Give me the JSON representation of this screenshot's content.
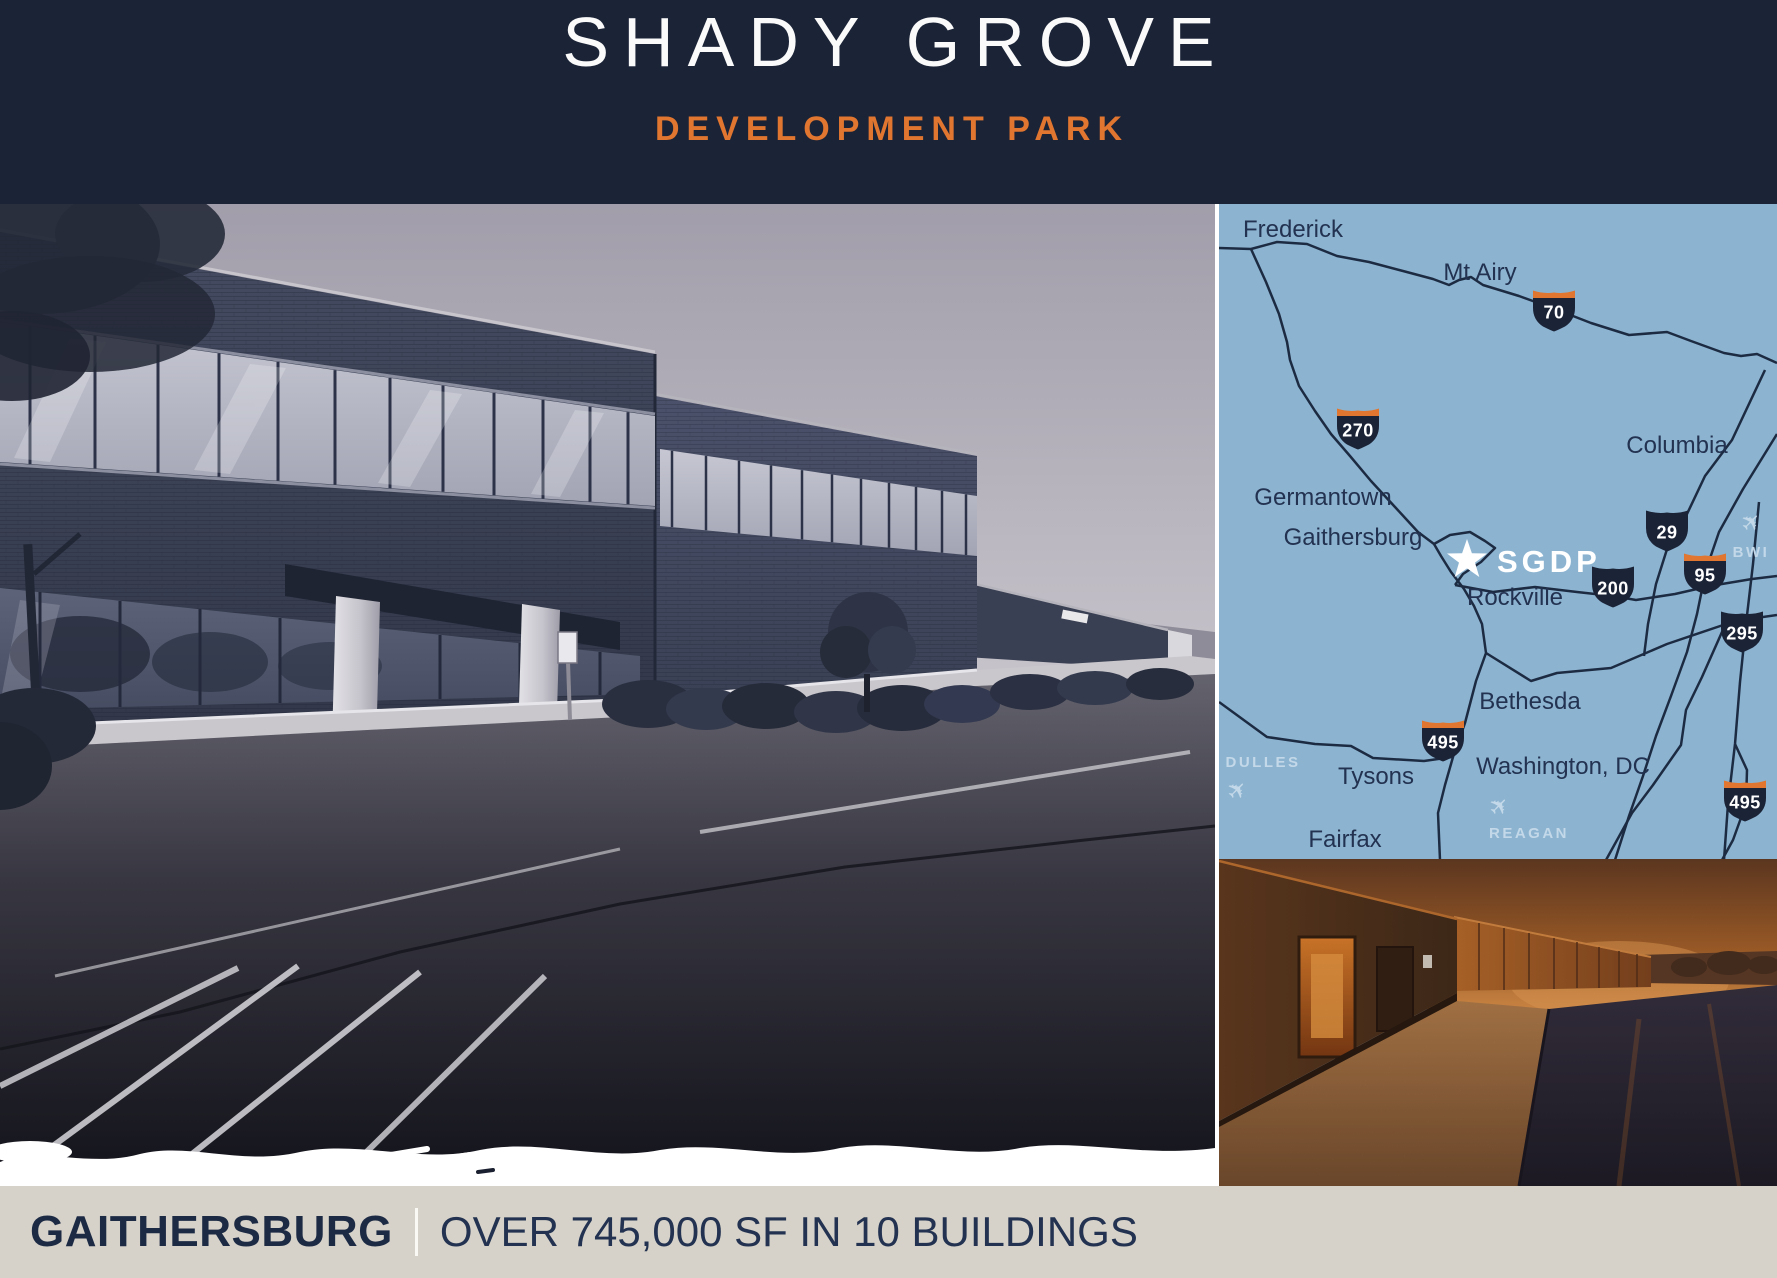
{
  "header": {
    "title": "SHADY GROVE",
    "subtitle": "DEVELOPMENT PARK"
  },
  "footer": {
    "location": "GAITHERSBURG",
    "divider": "|",
    "stats": "OVER 745,000 SF IN 10 BUILDINGS"
  },
  "map": {
    "cities": [
      {
        "label": "Frederick",
        "x": 74,
        "y": 33
      },
      {
        "label": "Mt Airy",
        "x": 261,
        "y": 76
      },
      {
        "label": "Columbia",
        "x": 458,
        "y": 249
      },
      {
        "label": "Germantown",
        "x": 104,
        "y": 301
      },
      {
        "label": "Gaithersburg",
        "x": 134,
        "y": 341
      },
      {
        "label": "Rockville",
        "x": 296,
        "y": 401
      },
      {
        "label": "Bethesda",
        "x": 311,
        "y": 505
      },
      {
        "label": "Tysons",
        "x": 157,
        "y": 580
      },
      {
        "label": "Washington, DC",
        "x": 344,
        "y": 570
      },
      {
        "label": "Fairfax",
        "x": 126,
        "y": 643
      }
    ],
    "site": {
      "label": "SGDP",
      "icon": "star",
      "x": 248,
      "y": 356,
      "label_x": 278,
      "label_y": 368
    },
    "airports": [
      {
        "label": "BWI",
        "x": 532,
        "y": 353,
        "plane_x": 538,
        "plane_y": 324
      },
      {
        "label": "DULLES",
        "x": 44,
        "y": 563,
        "plane_x": 24,
        "plane_y": 592
      },
      {
        "label": "REAGAN",
        "x": 310,
        "y": 634,
        "plane_x": 286,
        "plane_y": 608
      }
    ],
    "shields": [
      {
        "number": "70",
        "interstate": true,
        "x": 335,
        "y": 106
      },
      {
        "number": "270",
        "interstate": true,
        "x": 139,
        "y": 224
      },
      {
        "number": "29",
        "interstate": false,
        "x": 448,
        "y": 326
      },
      {
        "number": "95",
        "interstate": true,
        "x": 486,
        "y": 369
      },
      {
        "number": "200",
        "interstate": false,
        "x": 394,
        "y": 382
      },
      {
        "number": "295",
        "interstate": false,
        "x": 523,
        "y": 427
      },
      {
        "number": "495",
        "interstate": true,
        "x": 224,
        "y": 536
      },
      {
        "number": "495",
        "interstate": true,
        "x": 526,
        "y": 596
      }
    ]
  },
  "colors": {
    "header_bg": "#1b2337",
    "accent_orange": "#e0762f",
    "map_bg": "#8cb4d1",
    "road": "#1d2b42",
    "map_label": "#223250",
    "airport_label": "#c3d8e8",
    "shield_navy": "#1b2337",
    "site_white": "#ffffff",
    "footer_bg": "#d6d2c9",
    "footer_text": "#1c2a44"
  }
}
